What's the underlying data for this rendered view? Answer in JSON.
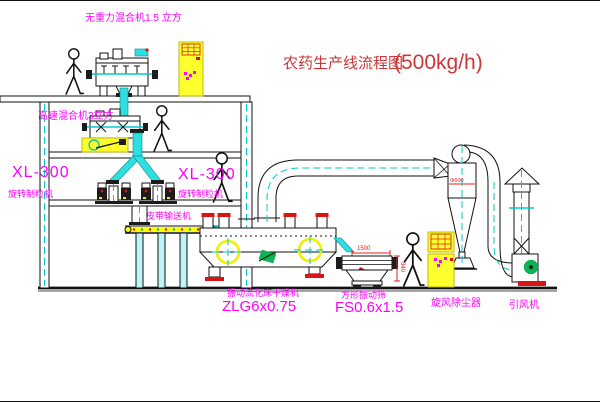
{
  "title": {
    "name": "农药生产线流程图",
    "capacity": "(500kg/h)"
  },
  "equipment": {
    "mixer_top_label": "无重力混合机1.5 立方",
    "mixer_mid_label": "高速混合机3立方",
    "granulator_left_model": "XL-300",
    "granulator_left_name": "旋转制粒机",
    "granulator_right_model": "XL-300",
    "granulator_right_name": "旋转制粒机",
    "belt_conveyor_label": "皮带输送机",
    "dryer_name": "振动流化床干燥机",
    "dryer_model": "ZLG6x0.75",
    "screen_name": "方形振动筛",
    "screen_model": "FS0.6x1.5",
    "cyclone_label": "旋风除尘器",
    "fan_label": "引风机"
  },
  "dimensions": {
    "screen_length": "1500",
    "screen_height": "340",
    "cyclone_marking": "Φ600"
  },
  "colors": {
    "label_magenta": "#ff00ff",
    "title_red": "#cc3636",
    "dimension_red": "#e02222",
    "cabinet_yellow": "#ffff2e",
    "material_cyan": "#2fdede",
    "alert_red": "#d81414",
    "motor_green": "#0eb351"
  }
}
